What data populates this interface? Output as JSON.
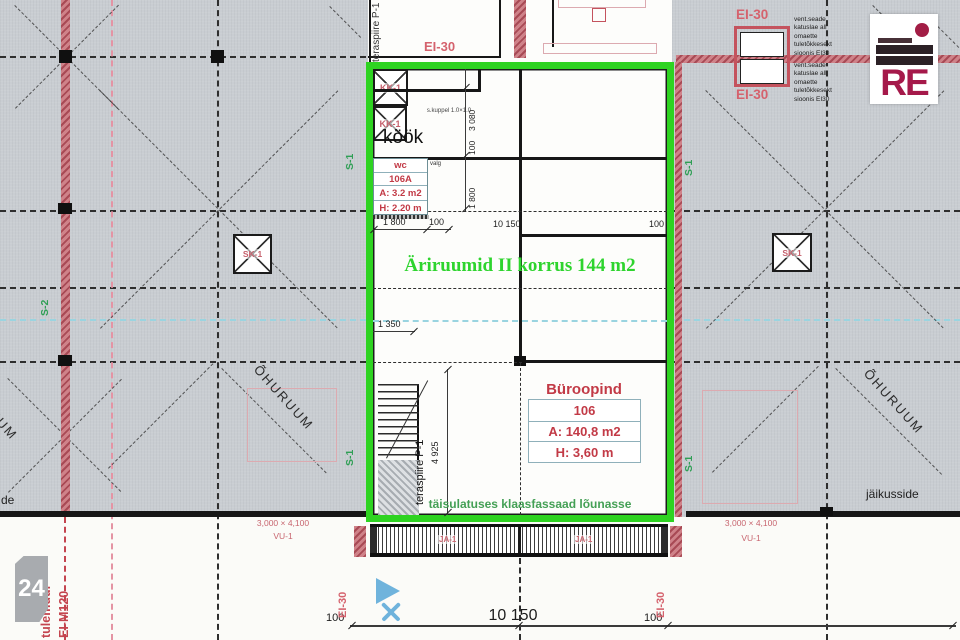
{
  "drawing": {
    "green_title": "Äriruumid II korrus 144 m2",
    "facade_note": "täisulatuses klaasfassaad lõunasse",
    "kitchen_label": "köök",
    "stair_railing": "teraspiire P-1",
    "page_number": "24",
    "logo_text": "RE"
  },
  "unit": {
    "title": "Büroopind",
    "number": "106",
    "area": "A: 140,8 m2",
    "height": "H: 3,60 m"
  },
  "wc": {
    "title": "wc",
    "number": "106A",
    "area": "A: 3.2 m2",
    "height": "H: 2.20 m",
    "light_note": "valg"
  },
  "labels": {
    "ei30": "EI-30",
    "s1": "S-1",
    "s2": "S-2",
    "sk1": "SK-1",
    "kk1": "KK-1",
    "kk1_note": "s.kuppel 1.0×1.0",
    "ja1": "JA-1",
    "vu1": "VU-1",
    "vu1_size": "3,000 × 4,100",
    "ohuruum": "ÕHURUUM",
    "jaikusside": "jäikusside",
    "jaikusside_cut": "de",
    "tulemuur": "tulemüür",
    "ei_m120": "EI-M120"
  },
  "vent_note_lines": [
    "vent.seade",
    "katuslae all",
    "omaette",
    "tuletõkkesekt",
    "sioonis EI30"
  ],
  "dims": {
    "d3080": "3 080",
    "d100": "100",
    "d1800": "1 800",
    "d1350": "1 350",
    "d4925": "4 925",
    "d10150": "10 150"
  }
}
